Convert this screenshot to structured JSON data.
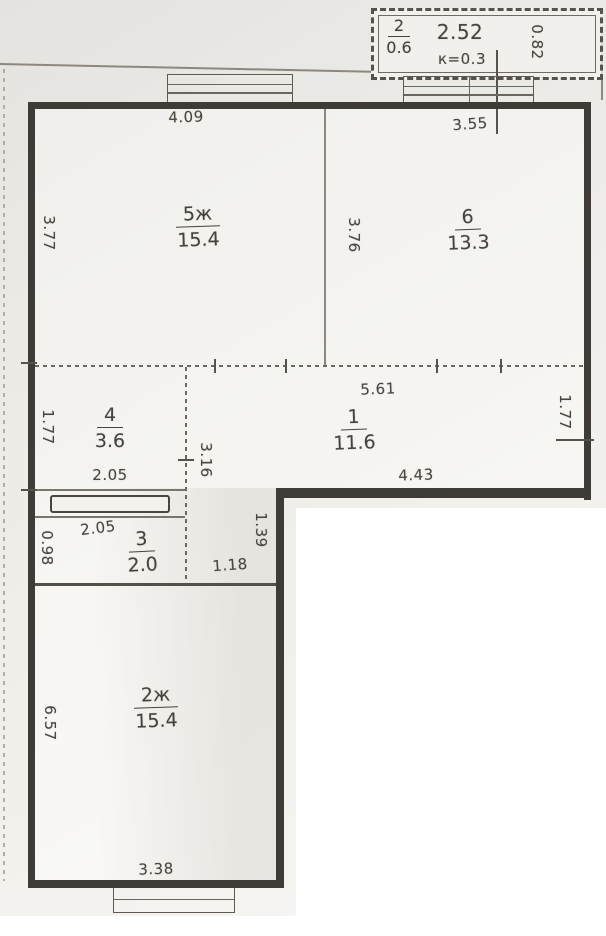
{
  "plan": {
    "rooms": {
      "r5": {
        "num": "5ж",
        "area": "15.4"
      },
      "r6": {
        "num": "6",
        "area": "13.3"
      },
      "r1": {
        "num": "1",
        "area": "11.6"
      },
      "r4": {
        "num": "4",
        "area": "3.6"
      },
      "r3": {
        "num": "3",
        "area": "2.0"
      },
      "r2": {
        "num": "2ж",
        "area": "15.4"
      }
    },
    "balcony": {
      "num": "2",
      "area": "0.6",
      "width": "2.52",
      "coef": "к=0.3",
      "depth": "0.82"
    },
    "dims": {
      "room5_width": "4.09",
      "room6_width": "3.55",
      "room5_height": "3.77",
      "room6_height": "3.76",
      "hall_width_top": "5.61",
      "hall_width_bottom": "4.43",
      "hall_height_right": "1.77",
      "room4_height": "1.77",
      "room4_width": "2.05",
      "room3_width": "2.05",
      "room3_height": "0.98",
      "corridor_height": "3.16",
      "corridor_lower_height": "1.39",
      "corridor_width": "1.18",
      "room2_height": "6.57",
      "room2_width": "3.38"
    },
    "colors": {
      "wall": "#3f3b36",
      "paper": "#f0eeea",
      "ink": "#4a453e"
    }
  }
}
